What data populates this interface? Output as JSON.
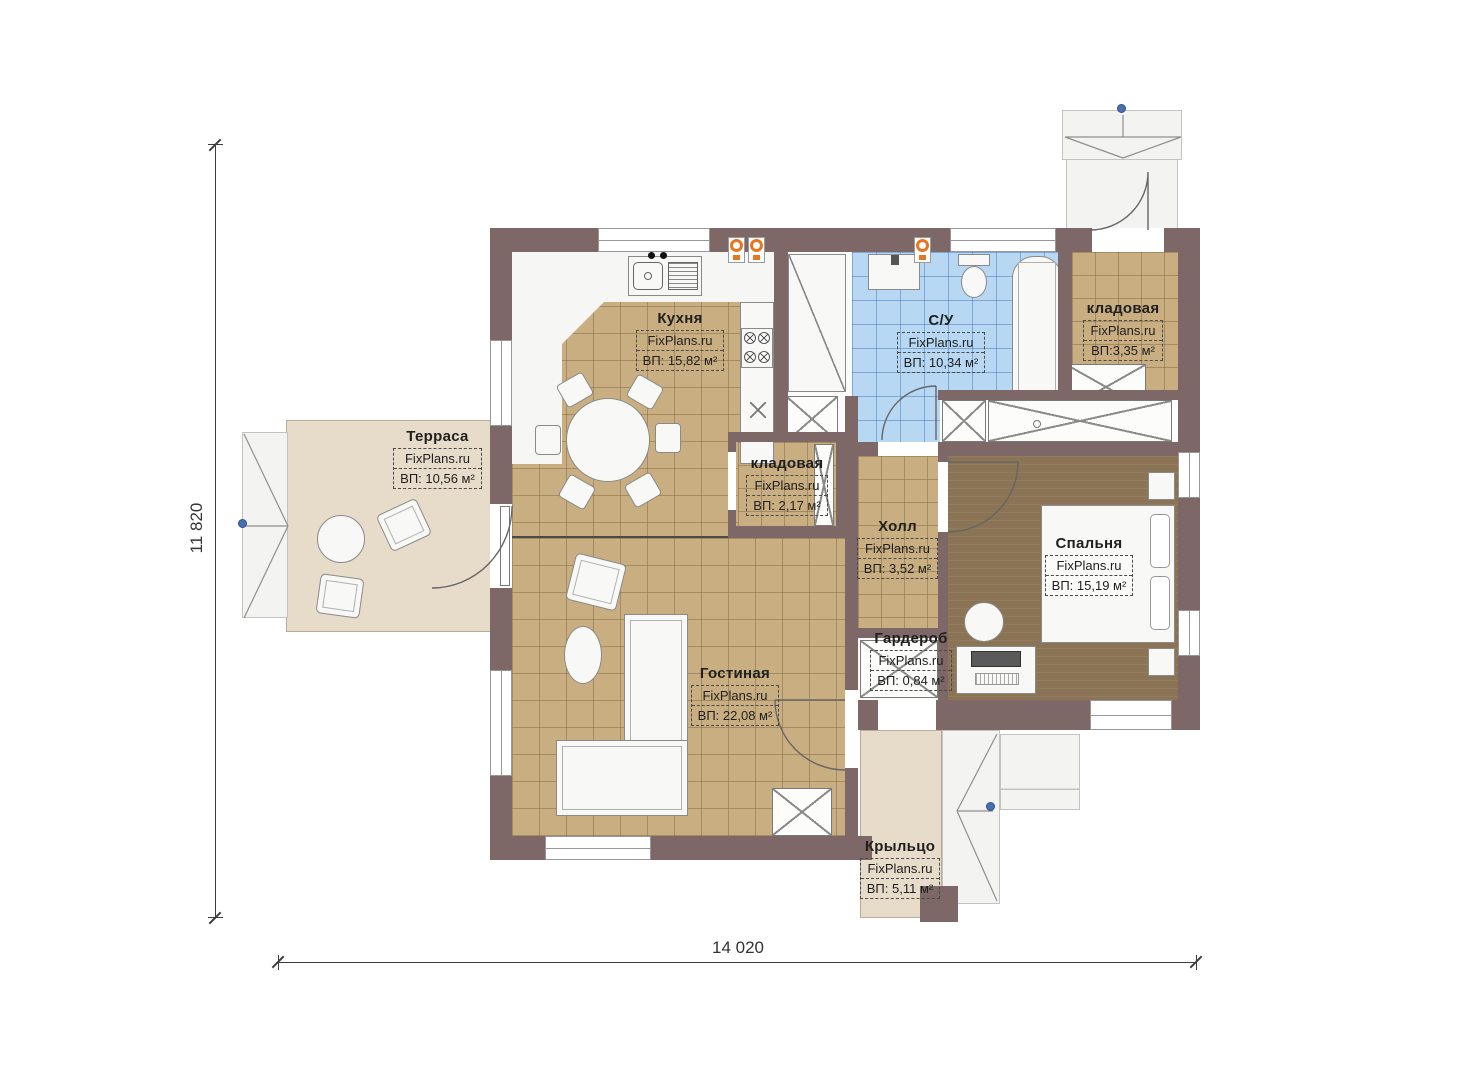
{
  "watermark": "FixPlans.ru",
  "dimensions": {
    "height_label": "11 820",
    "width_label": "14 020"
  },
  "rooms": [
    {
      "name": "Кухня",
      "area": "ВП: 15,82 м²"
    },
    {
      "name": "Терраса",
      "area": "ВП: 10,56 м²"
    },
    {
      "name": "С/У",
      "area": "ВП: 10,34 м²"
    },
    {
      "name": "кладовая",
      "area": "ВП:3,35 м²"
    },
    {
      "name": "кладовая",
      "area": "ВП: 2,17 м²"
    },
    {
      "name": "Холл",
      "area": "ВП: 3,52 м²"
    },
    {
      "name": "Спальня",
      "area": "ВП: 15,19 м²"
    },
    {
      "name": "Гардероб",
      "area": "ВП: 0,84 м²"
    },
    {
      "name": "Гостиная",
      "area": "ВП: 22,08 м²"
    },
    {
      "name": "Крыльцо",
      "area": "ВП: 5,11 м²"
    }
  ],
  "colors": {
    "wall": "#7d6767",
    "floor_tile": "#c9ae82",
    "bedroom_floor": "#8b7355",
    "bathroom_tile": "#b7d7f3",
    "terrace_slab": "#e7dbc9",
    "marker_orange": "#e8761f",
    "handle_blue": "#4a6fae"
  }
}
